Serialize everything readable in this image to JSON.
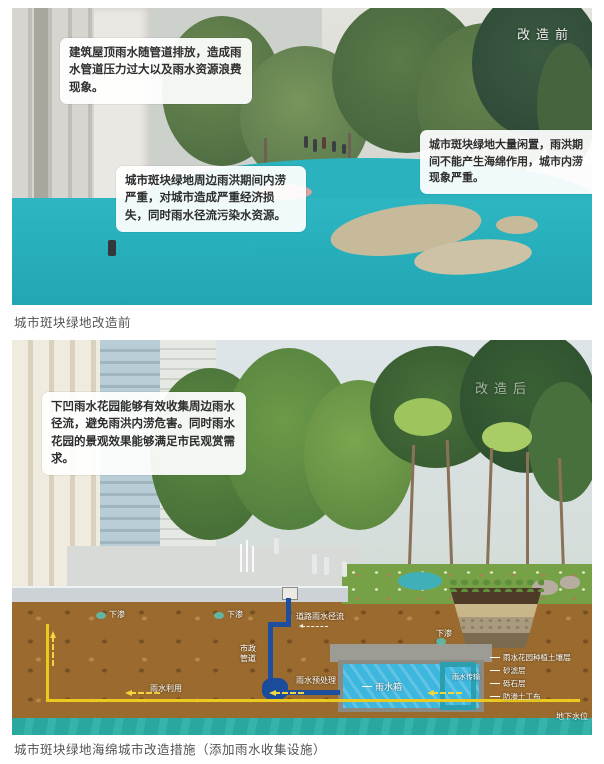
{
  "figure_before": {
    "watermark": "改造前",
    "caption": "城市斑块绿地改造前",
    "callouts": [
      {
        "text": "建筑屋顶雨水随管道排放，造成雨水管道压力过大以及雨水资源浪费现象。"
      },
      {
        "text": "城市斑块绿地周边雨洪期间内涝严重，对城市造成严重经济损失，同时雨水径流污染水资源。"
      },
      {
        "text": "城市斑块绿地大量闲置，雨洪期间不能产生海绵作用，城市内涝现象严重。"
      }
    ]
  },
  "figure_after": {
    "watermark": "改造后",
    "caption": "城市斑块绿地海绵城市改造措施（添加雨水收集设施）",
    "callouts": [
      {
        "text": "下凹雨水花园能够有效收集周边雨水径流，避免雨洪内涝危害。同时雨水花园的景观效果能够满足市民观赏需求。"
      }
    ],
    "diagram_labels": {
      "infiltration": "下渗",
      "road_runoff": "道路雨水径流",
      "municipal_pipe": "市政管道",
      "pretreatment": "雨水预处理",
      "tank": "雨水箱",
      "rain_reuse": "雨水利用",
      "transfer": "雨水传输",
      "groundwater": "地下水位",
      "layers": [
        "雨水花园种植土壤层",
        "砂滤层",
        "砾石层",
        "防渗土工布"
      ]
    }
  },
  "colors": {
    "flood_teal": "#29b2be",
    "soil_brown": "#9a6a2e",
    "tank_water": "#3eb7de",
    "groundwater": "#2aa79e",
    "pipe_blue": "#1d4f9e",
    "reuse_yellow": "#ecc91f"
  }
}
